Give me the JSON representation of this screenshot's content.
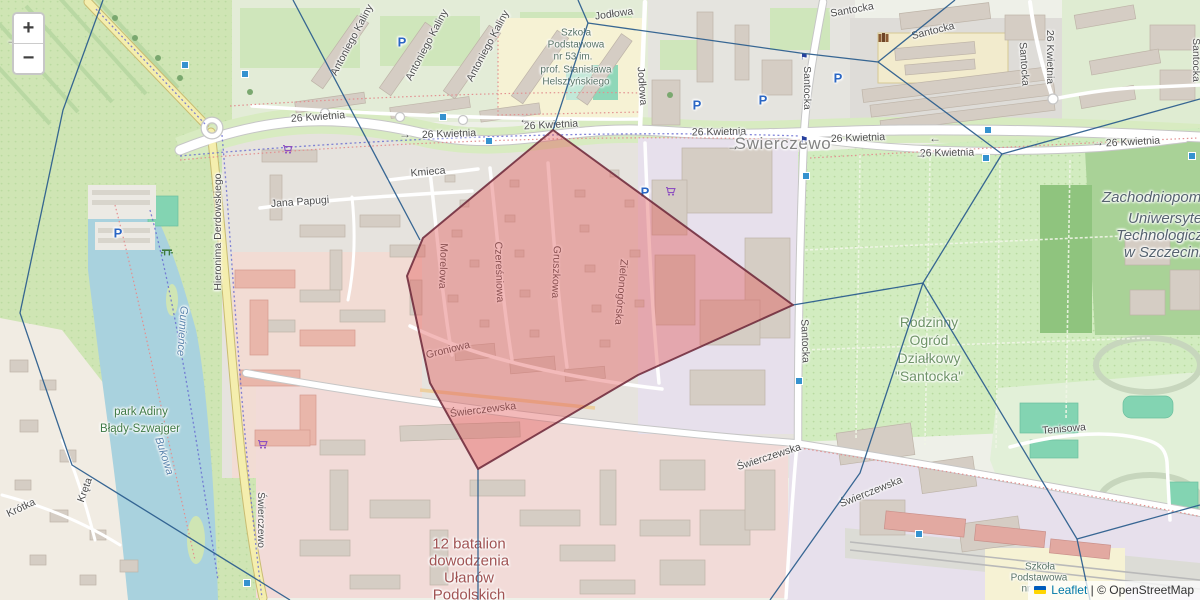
{
  "controls": {
    "zoom_in": "+",
    "zoom_out": "−"
  },
  "attribution": {
    "leaflet": "Leaflet",
    "separator": "|",
    "osm": "© OpenStreetMap"
  },
  "glyphs": {
    "parking": "P",
    "arrow_right": "→",
    "arrow_left": "←",
    "flag_marker": "⚑"
  },
  "streets": {
    "kwietnia": "26 Kwietnia",
    "santocka": "Santocka",
    "swierczewska": "Świerczewska",
    "derdowskiego": "Hieronima Derdowskiego",
    "kaliny": "Antoniego Kaliny",
    "jodlowa": "Jodłowa",
    "kmieca": "Kmieca",
    "papugi": "Jana Papugi",
    "morelowa": "Morelowa",
    "czeresniowa": "Czereśniowa",
    "gruszkowa": "Gruszkowa",
    "zielonogorska": "Zielonogórska",
    "groniowa": "Groniowa",
    "krotka": "Krótka",
    "kreta": "Kręta",
    "tenisowa": "Tenisowa"
  },
  "places": {
    "district": "Świerczewo",
    "park_line1": "park Adiny",
    "park_line2": "Błądy-Szwajger",
    "bukowa": "Bukowa",
    "gumience": "Gumieńce",
    "rod": [
      "Rodzinny",
      "Ogród",
      "Działkowy",
      "\"Santocka\""
    ],
    "university": [
      "Zachodniopomorski",
      "Uniwersytet",
      "Technologiczny",
      "w Szczecinie"
    ],
    "school_top": [
      "Szkoła",
      "Podstawowa",
      "nr 53 im.",
      "prof. Stanisława",
      "Helsztyńskiego"
    ],
    "school_br": [
      "Szkoła",
      "Podstawowa",
      "nr"
    ],
    "military": [
      "12 batalion",
      "dowodzenia",
      "Ułanów",
      "Podolskich"
    ]
  },
  "colors": {
    "overlay_fill": "#e25252",
    "overlay_stroke": "#6b2637",
    "boundary_blue": "#2d5f8e",
    "marker_blue": "#3592cf",
    "water": "#a9d2de",
    "park_green": "#cfe5b4",
    "attribution_link": "#0078A8"
  }
}
